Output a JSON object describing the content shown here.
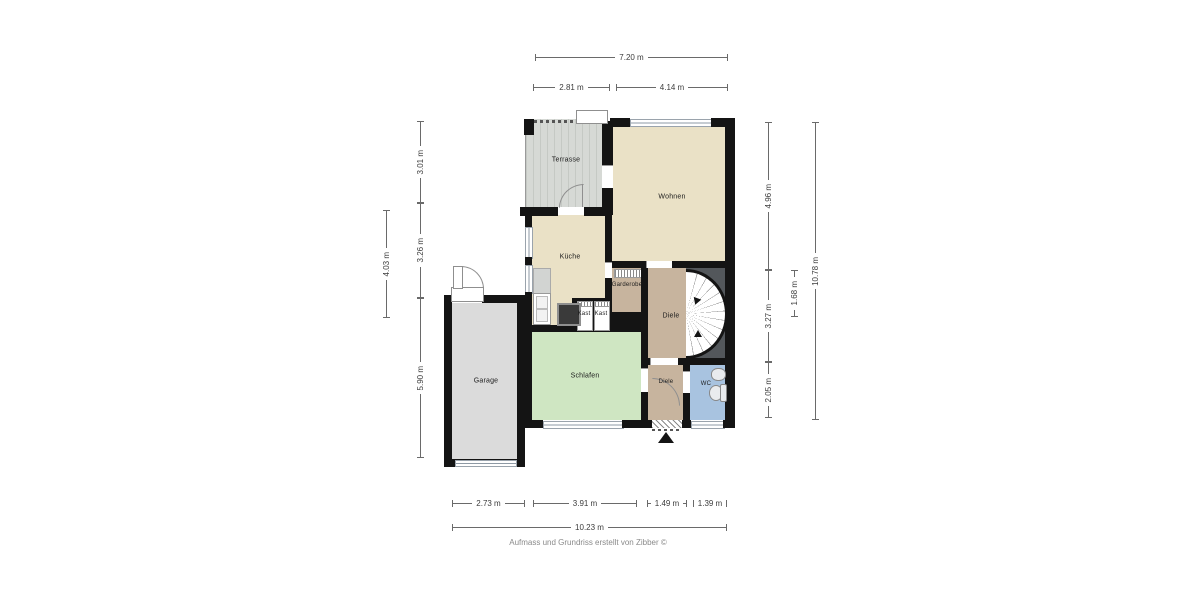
{
  "plan_title": "Erdgeschoss Grundriss",
  "rooms": {
    "terrasse": "Terrasse",
    "wohnen": "Wohnen",
    "kueche": "Küche",
    "garderobe": "Garderobe",
    "kast_a": "Kast",
    "kast_b": "Kast",
    "diele": "Diele",
    "schlafen": "Schlafen",
    "diele2": "Diele",
    "wc": "WC",
    "garage": "Garage"
  },
  "dimensions": {
    "top_total": "7.20 m",
    "top_a": "2.81 m",
    "top_b": "4.14 m",
    "left_outer": "4.03 m",
    "left_a": "3.01 m",
    "left_b": "3.26 m",
    "left_c": "5.90 m",
    "right_a": "4.96 m",
    "right_b": "3.27 m",
    "right_c": "2.05 m",
    "right_mid": "1.68 m",
    "right_total": "10.78 m",
    "bottom_a": "2.73 m",
    "bottom_b": "3.91 m",
    "bottom_c": "1.49 m",
    "bottom_d": "1.39 m",
    "bottom_total": "10.23 m"
  },
  "footer": "Aufmass und Grundriss erstellt von Zibber ©",
  "colors": {
    "wall": "#141414",
    "living_beige": "#eae1c6",
    "bedroom_green": "#cfe6c2",
    "wc_blue": "#a8c3e0",
    "hall_brown": "#c7b49e",
    "garage_grey": "#dbdbdb",
    "terrace_grey": "#d6d9d5",
    "stair_dark": "#53575b"
  }
}
